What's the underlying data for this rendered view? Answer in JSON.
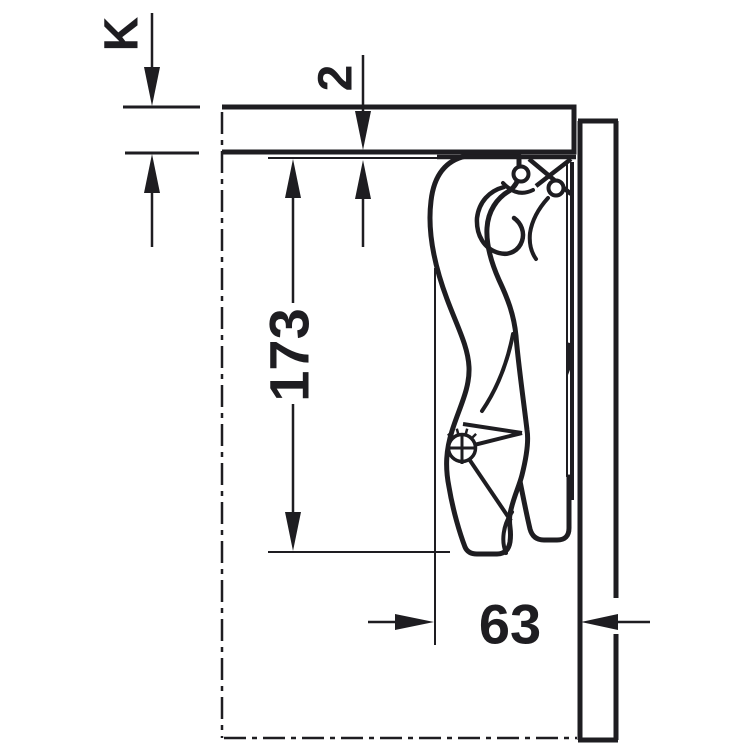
{
  "drawing": {
    "ink_color": "#1e1d21",
    "background_color": "#ffffff"
  },
  "dimensions": {
    "k": {
      "label": "K"
    },
    "gap": {
      "label": "2"
    },
    "height": {
      "label": "173"
    },
    "depth": {
      "label": "63"
    }
  }
}
